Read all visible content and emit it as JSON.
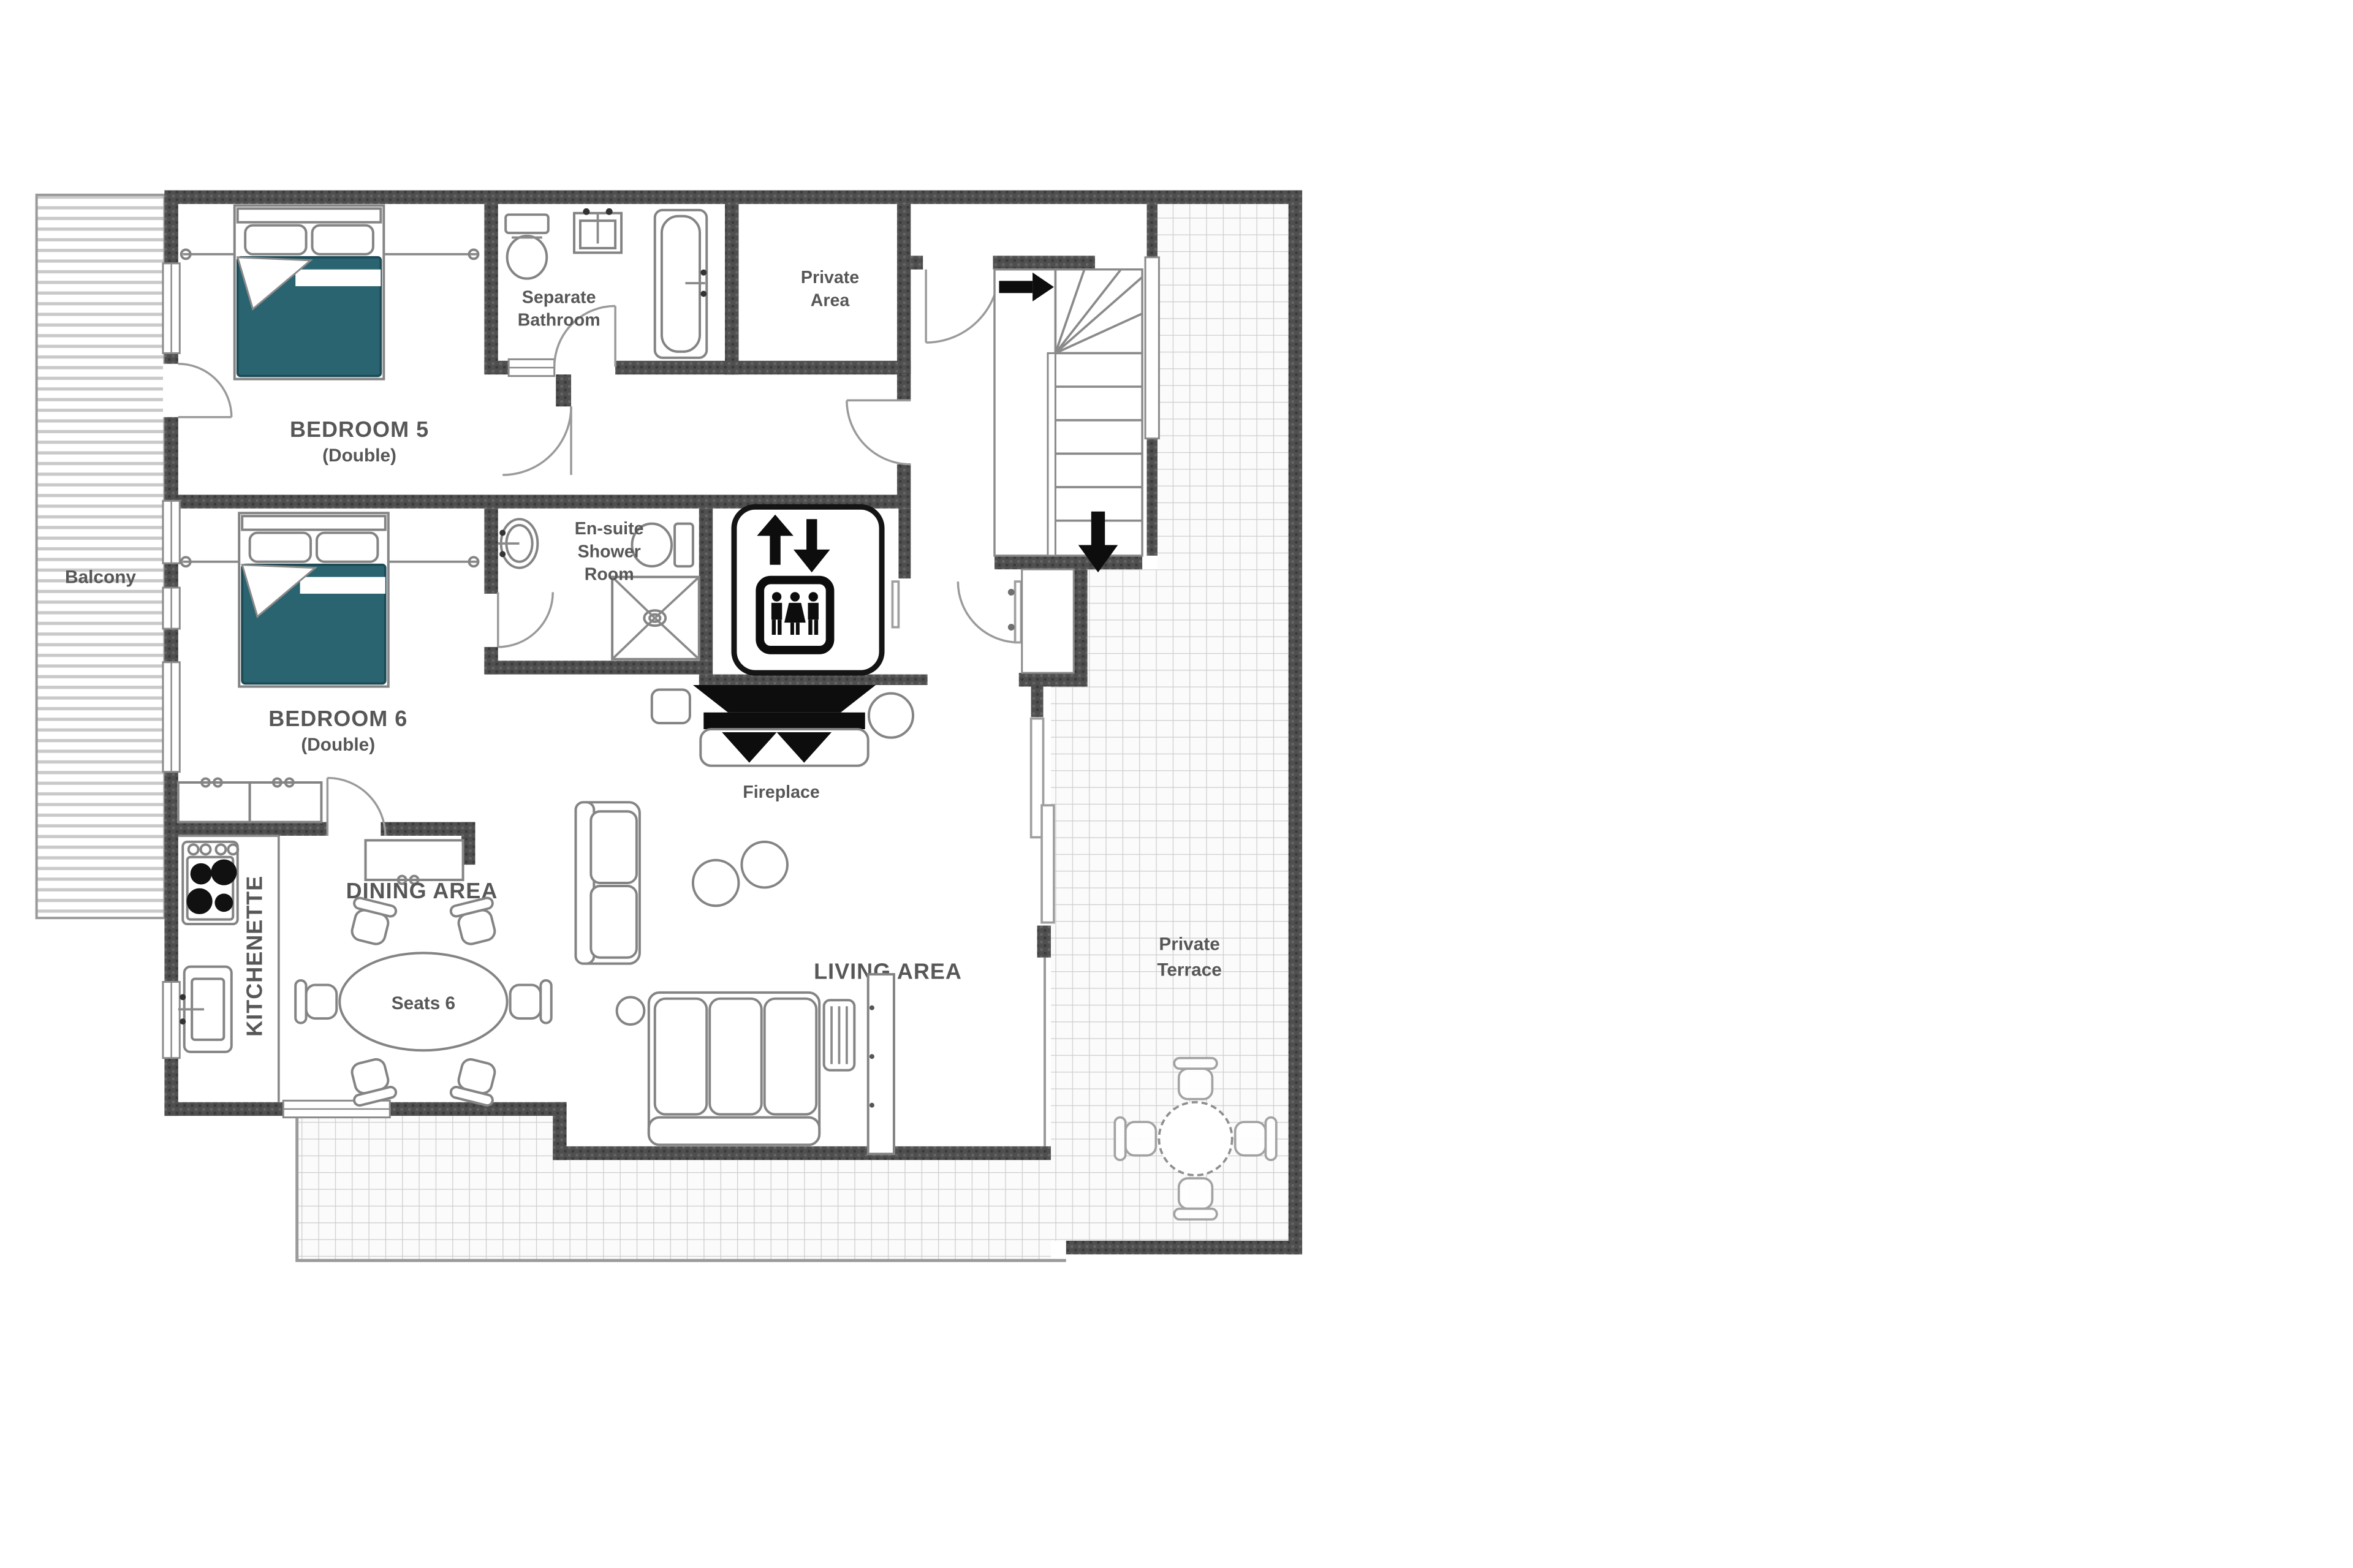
{
  "document": {
    "kind": "floor-plan"
  },
  "colors": {
    "wall": "#4f4f4f",
    "bed_accent": "#2a6471",
    "grid_line": "#cdcdcd",
    "label_text": "#575757",
    "icon_black": "#0d0d0d"
  },
  "labels": {
    "bedroom5": {
      "title": "BEDROOM 5",
      "subtitle": "(Double)"
    },
    "bedroom6": {
      "title": "BEDROOM 6",
      "subtitle": "(Double)"
    },
    "separate_bathroom": {
      "lines": [
        "Separate",
        "Bathroom"
      ]
    },
    "private_area": {
      "lines": [
        "Private",
        "Area"
      ]
    },
    "ensuite": {
      "lines": [
        "En-suite",
        "Shower",
        "Room"
      ]
    },
    "fireplace": {
      "title": "Fireplace"
    },
    "dining": {
      "title": "DINING AREA"
    },
    "dining_table": {
      "title": "Seats 6"
    },
    "kitchenette": {
      "title": "KITCHENETTE"
    },
    "living": {
      "title": "LIVING AREA"
    },
    "balcony": {
      "title": "Balcony"
    },
    "private_terrace": {
      "lines": [
        "Private",
        "Terrace"
      ]
    }
  },
  "icons": {
    "elevator": "elevator-lift-icon",
    "stairs_entry": "arrow-right-icon",
    "stairs_down": "arrow-down-icon"
  }
}
